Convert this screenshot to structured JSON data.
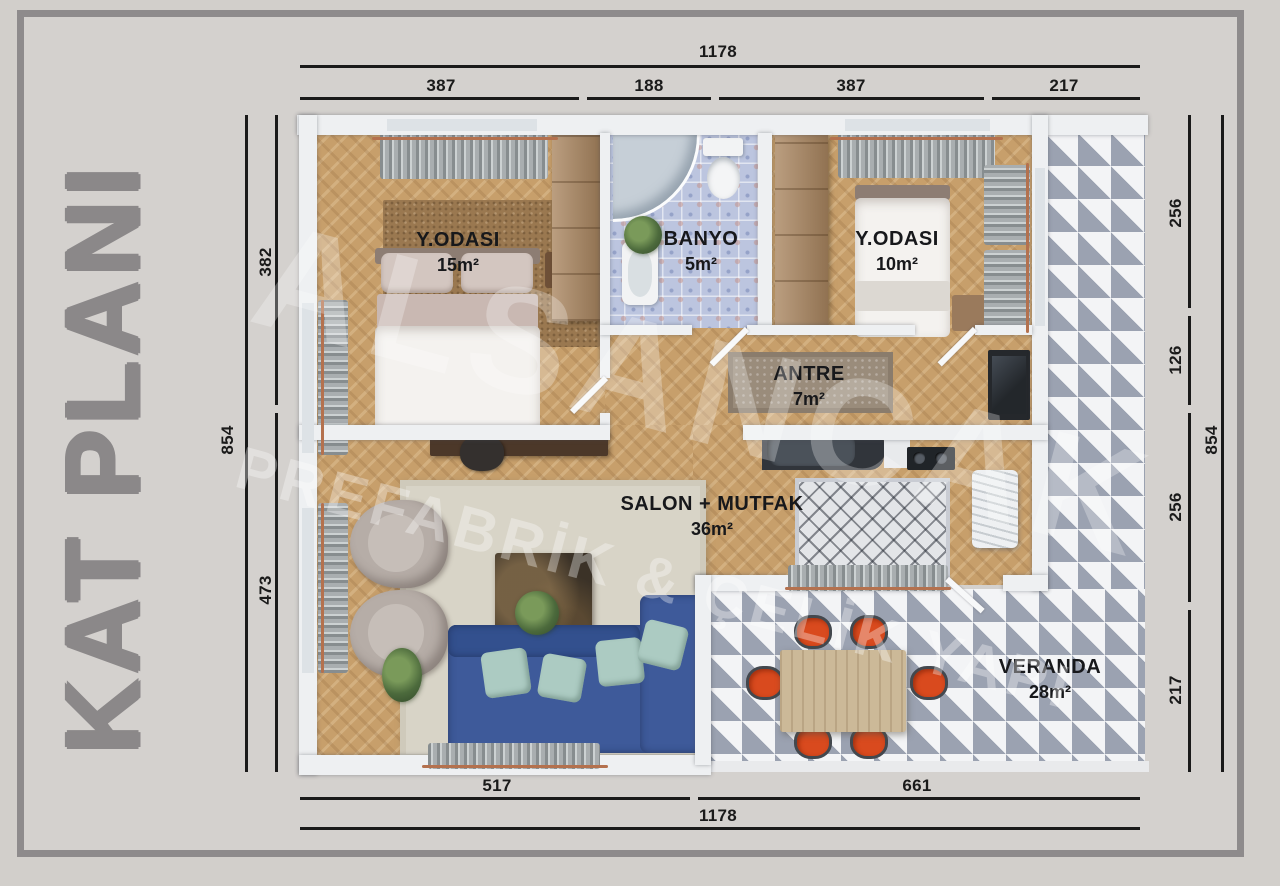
{
  "title": {
    "label": "KAT PLANI"
  },
  "watermark": {
    "brand": "ALSANCAK",
    "tagline": "PREFABRİK & ÇELİK YAPI"
  },
  "rooms": [
    {
      "name": "Y.ODASI",
      "area": "15m²"
    },
    {
      "name": "BANYO",
      "area": "5m²"
    },
    {
      "name": "Y.ODASI",
      "area": "10m²"
    },
    {
      "name": "ANTRE",
      "area": "7m²"
    },
    {
      "name": "SALON + MUTFAK",
      "area": "36m²"
    },
    {
      "name": "VERANDA",
      "area": "28m²"
    }
  ],
  "dimensions": {
    "top": {
      "total": "1178",
      "segments": [
        "387",
        "188",
        "387",
        "217"
      ]
    },
    "bottom": {
      "total": "1178",
      "segments": [
        "517",
        "661"
      ]
    },
    "left": {
      "total": "854",
      "segments": [
        "382",
        "473"
      ]
    },
    "right": {
      "total": "854",
      "segments": [
        "256",
        "126",
        "256",
        "217"
      ]
    }
  },
  "colors": {
    "background": "#d2cfcb",
    "inner_bg": "#d4d1ce",
    "frame_border": "#8e8b8c",
    "title_gray": "#8b8889",
    "dimension_ink": "#1a1a1a",
    "wall_white": "#eef0f2",
    "wood_floor": "#c79f6b",
    "bath_tile": "#bcc5df",
    "veranda_tile_gray": "#9ba2b1",
    "sofa_blue": "#3e5a9a",
    "chair_orange": "#d94a1e",
    "curtain_gray": "#a9aeb0",
    "copper": "#b4714e",
    "rug_beige": "#d8d4c7",
    "rug_brown": "#9a7850",
    "wardrobe_brown": "#aa8660"
  }
}
